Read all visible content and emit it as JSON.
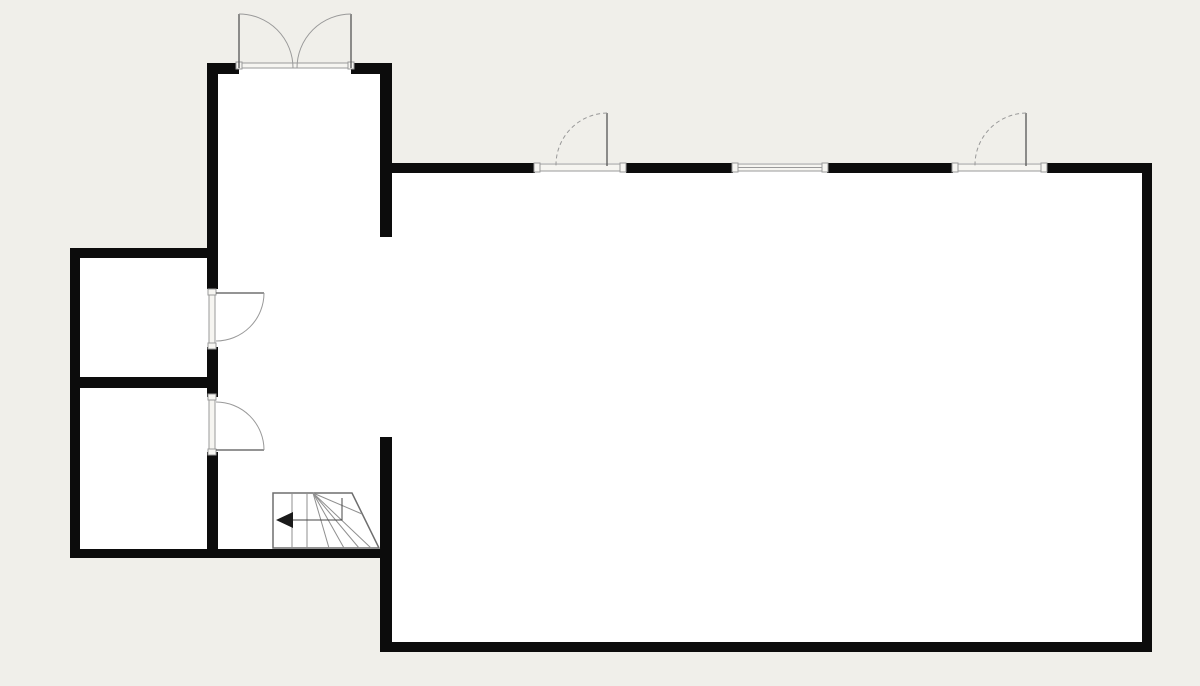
{
  "canvas": {
    "width": 1200,
    "height": 686
  },
  "colors": {
    "background": "#f0efea",
    "room_fill": "#ffffff",
    "wall": "#0c0c0c",
    "leaf_line": "#555555",
    "arc_line": "#999999",
    "sill_fill": "#f6f5f1",
    "sill_line": "#9a9a9a",
    "stair_line": "#8f8f8f",
    "stair_outline": "#6e6e6e",
    "walk_line": "#444444",
    "arrow": "#1a1a1a"
  },
  "rooms": [
    {
      "name": "hallway-interior",
      "x": 207,
      "y": 63,
      "w": 185,
      "h": 495
    },
    {
      "name": "room-upper-left-interior",
      "x": 70,
      "y": 248,
      "w": 148,
      "h": 140
    },
    {
      "name": "room-lower-left-interior",
      "x": 70,
      "y": 377,
      "w": 148,
      "h": 181
    },
    {
      "name": "main-room-interior",
      "x": 380,
      "y": 163,
      "w": 772,
      "h": 489
    }
  ],
  "walls": [
    {
      "name": "hall-top-wall-left",
      "x": 207,
      "y": 63,
      "w": 32,
      "h": 11
    },
    {
      "name": "hall-top-wall-right",
      "x": 351,
      "y": 63,
      "w": 41,
      "h": 11
    },
    {
      "name": "hall-left-wall-upper",
      "x": 207,
      "y": 63,
      "w": 11,
      "h": 226
    },
    {
      "name": "hall-left-wall-mid",
      "x": 207,
      "y": 347,
      "w": 11,
      "h": 50
    },
    {
      "name": "hall-left-wall-lower",
      "x": 207,
      "y": 452,
      "w": 11,
      "h": 106
    },
    {
      "name": "hall-right-wall-upper",
      "x": 380,
      "y": 63,
      "w": 12,
      "h": 174
    },
    {
      "name": "main-left-wall-lower",
      "x": 380,
      "y": 437,
      "w": 12,
      "h": 215
    },
    {
      "name": "west-outer-wall",
      "x": 70,
      "y": 248,
      "w": 10,
      "h": 310
    },
    {
      "name": "west-top-wall",
      "x": 70,
      "y": 248,
      "w": 148,
      "h": 10
    },
    {
      "name": "west-middle-wall",
      "x": 70,
      "y": 377,
      "w": 148,
      "h": 11
    },
    {
      "name": "south-west-wall",
      "x": 70,
      "y": 549,
      "w": 322,
      "h": 9
    },
    {
      "name": "main-top-wall-1",
      "x": 380,
      "y": 163,
      "w": 155,
      "h": 10
    },
    {
      "name": "main-top-wall-2",
      "x": 626,
      "y": 163,
      "w": 107,
      "h": 10
    },
    {
      "name": "main-top-wall-3",
      "x": 827,
      "y": 163,
      "w": 126,
      "h": 10
    },
    {
      "name": "main-top-wall-4",
      "x": 1047,
      "y": 163,
      "w": 105,
      "h": 10
    },
    {
      "name": "main-right-wall",
      "x": 1142,
      "y": 163,
      "w": 10,
      "h": 489
    },
    {
      "name": "main-bottom-wall",
      "x": 380,
      "y": 642,
      "w": 772,
      "h": 10
    }
  ],
  "openings": [
    {
      "name": "entry-door-sill",
      "x": 239,
      "y": 63,
      "w": 112,
      "h": 5,
      "style": "sill"
    },
    {
      "name": "main-door-a-sill",
      "x": 537,
      "y": 164,
      "w": 86,
      "h": 7,
      "style": "sill"
    },
    {
      "name": "window-sill",
      "x": 735,
      "y": 164,
      "w": 90,
      "h": 7,
      "style": "window"
    },
    {
      "name": "main-door-b-sill",
      "x": 955,
      "y": 164,
      "w": 89,
      "h": 7,
      "style": "sill"
    },
    {
      "name": "room-door-a-frame",
      "x": 209,
      "y": 292,
      "w": 6,
      "h": 54,
      "style": "sill"
    },
    {
      "name": "room-door-b-frame",
      "x": 209,
      "y": 397,
      "w": 6,
      "h": 55,
      "style": "sill"
    }
  ],
  "doors": [
    {
      "name": "entry-door-left",
      "leaf": [
        239,
        68,
        239,
        14
      ],
      "arc": {
        "sx": 239,
        "sy": 14,
        "ex": 293,
        "ey": 68,
        "r": 54,
        "sweep": 1,
        "dashed": false
      }
    },
    {
      "name": "entry-door-right",
      "leaf": [
        351,
        68,
        351,
        14
      ],
      "arc": {
        "sx": 351,
        "sy": 14,
        "ex": 297,
        "ey": 68,
        "r": 54,
        "sweep": 0,
        "dashed": false
      }
    },
    {
      "name": "main-door-a",
      "leaf": [
        607,
        166,
        607,
        113
      ],
      "arc": {
        "sx": 607,
        "sy": 113,
        "ex": 556,
        "ey": 166,
        "r": 52,
        "sweep": 0,
        "dashed": true
      }
    },
    {
      "name": "main-door-b",
      "leaf": [
        1026,
        166,
        1026,
        113
      ],
      "arc": {
        "sx": 1026,
        "sy": 113,
        "ex": 975,
        "ey": 166,
        "r": 52,
        "sweep": 0,
        "dashed": true
      }
    },
    {
      "name": "room-door-a",
      "leaf": [
        216,
        293,
        264,
        293
      ],
      "arc": {
        "sx": 264,
        "sy": 293,
        "ex": 216,
        "ey": 341,
        "r": 48,
        "sweep": 1,
        "dashed": false
      }
    },
    {
      "name": "room-door-b",
      "leaf": [
        216,
        450,
        264,
        450
      ],
      "arc": {
        "sx": 216,
        "sy": 402,
        "ex": 264,
        "ey": 450,
        "r": 48,
        "sweep": 1,
        "dashed": false
      }
    }
  ],
  "stairs": {
    "name": "winder-stairs",
    "outline": "273,493 352,493 379,548 273,548",
    "treads": [
      [
        292,
        493,
        292,
        548
      ],
      [
        307,
        493,
        307,
        548
      ]
    ],
    "fan_origin": [
      313,
      493
    ],
    "fan_targets": [
      [
        329,
        548
      ],
      [
        344,
        548
      ],
      [
        359,
        548
      ],
      [
        371,
        548
      ],
      [
        362,
        514
      ]
    ],
    "walk_line": "342,498 342,520 284,520",
    "arrow": "276,520 293,512 293,528"
  }
}
